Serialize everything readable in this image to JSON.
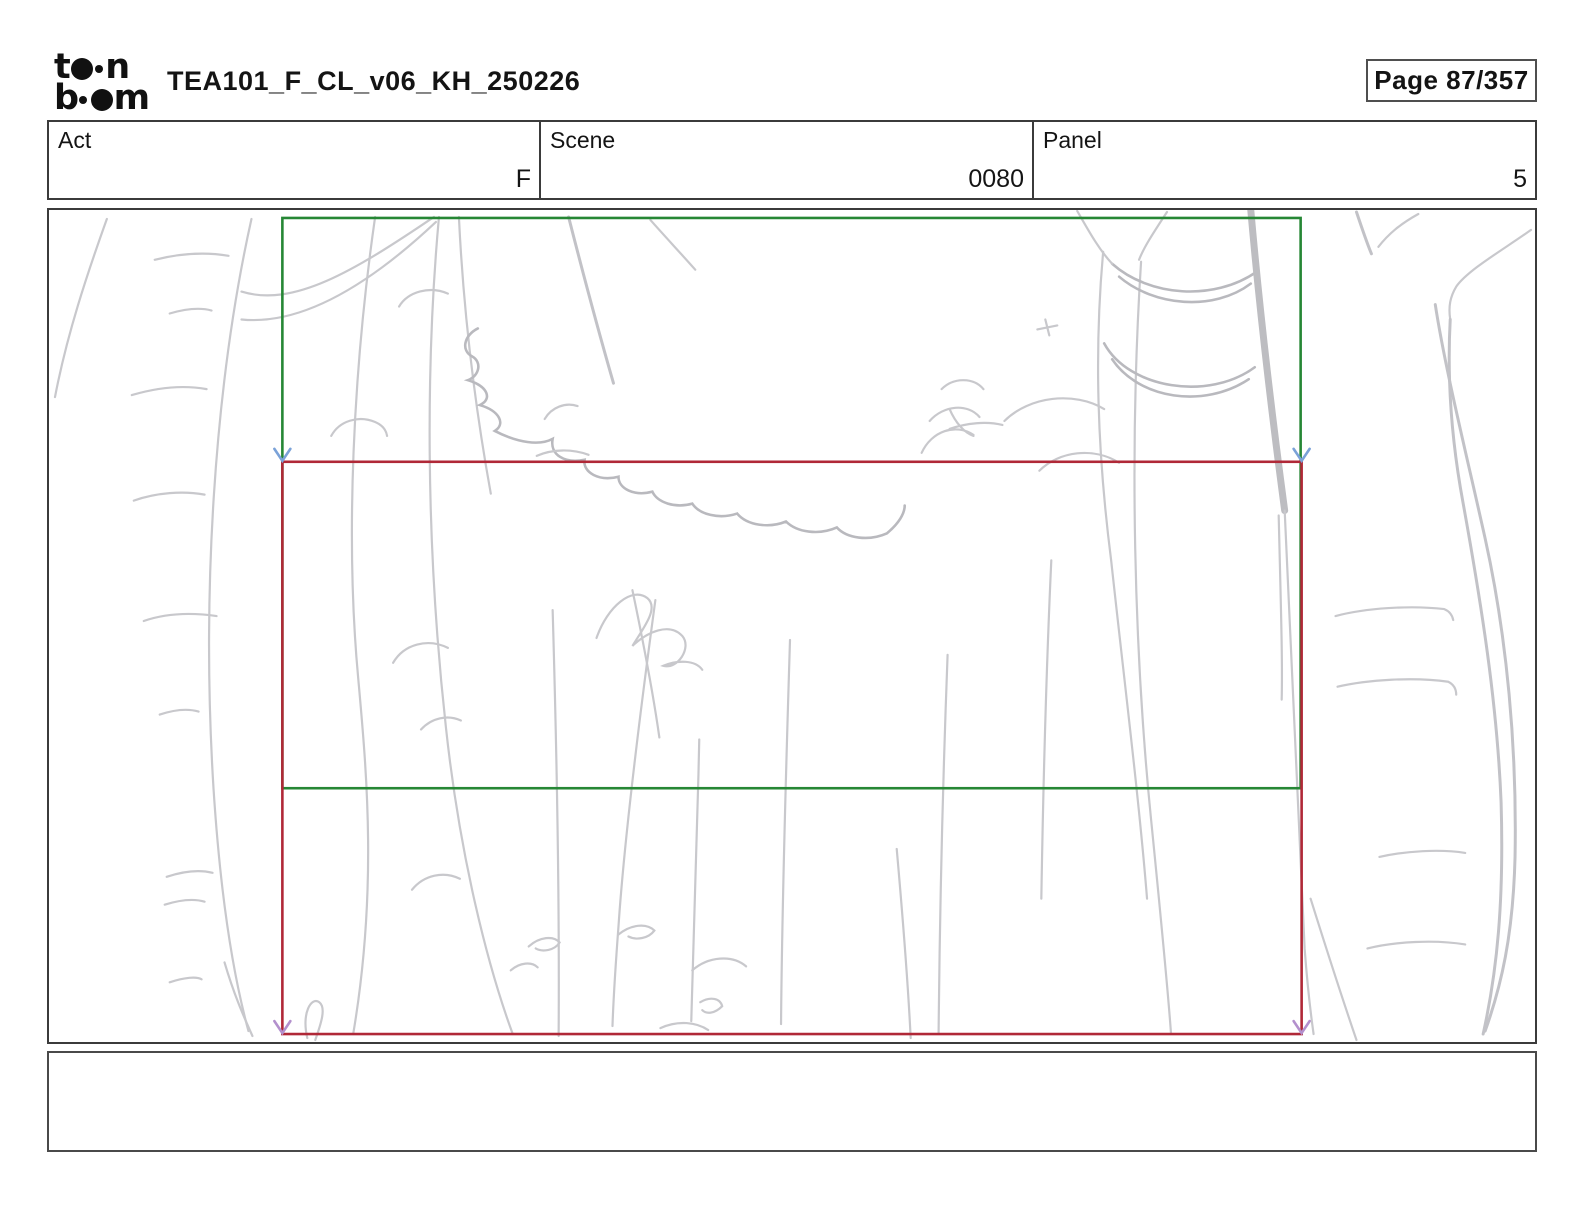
{
  "page": {
    "width": 1584,
    "height": 1224,
    "background": "#ffffff"
  },
  "header": {
    "logo": {
      "top_left": "t",
      "top_right": "n",
      "bottom_left": "b",
      "bottom_right": "m",
      "color": "#111111"
    },
    "title": "TEA101_F_CL_v06_KH_250226",
    "page_indicator": "Page 87/357"
  },
  "info_bar": {
    "cells": [
      {
        "label": "Act",
        "value": "F"
      },
      {
        "label": "Scene",
        "value": "0080"
      },
      {
        "label": "Panel",
        "value": "5"
      }
    ]
  },
  "panel": {
    "camera": {
      "start_frame_color": "#268735",
      "end_frame_color": "#b02837",
      "top_arrow_color": "#7ba2d8",
      "bottom_arrow_color": "#b390cd",
      "motion": "pan-down"
    },
    "sketch": {
      "description": "rough light-gray pencil sketch of forest tree trunks with hanging foliage",
      "stroke_color": "#c8c8cc"
    }
  },
  "caption": {
    "text": ""
  }
}
